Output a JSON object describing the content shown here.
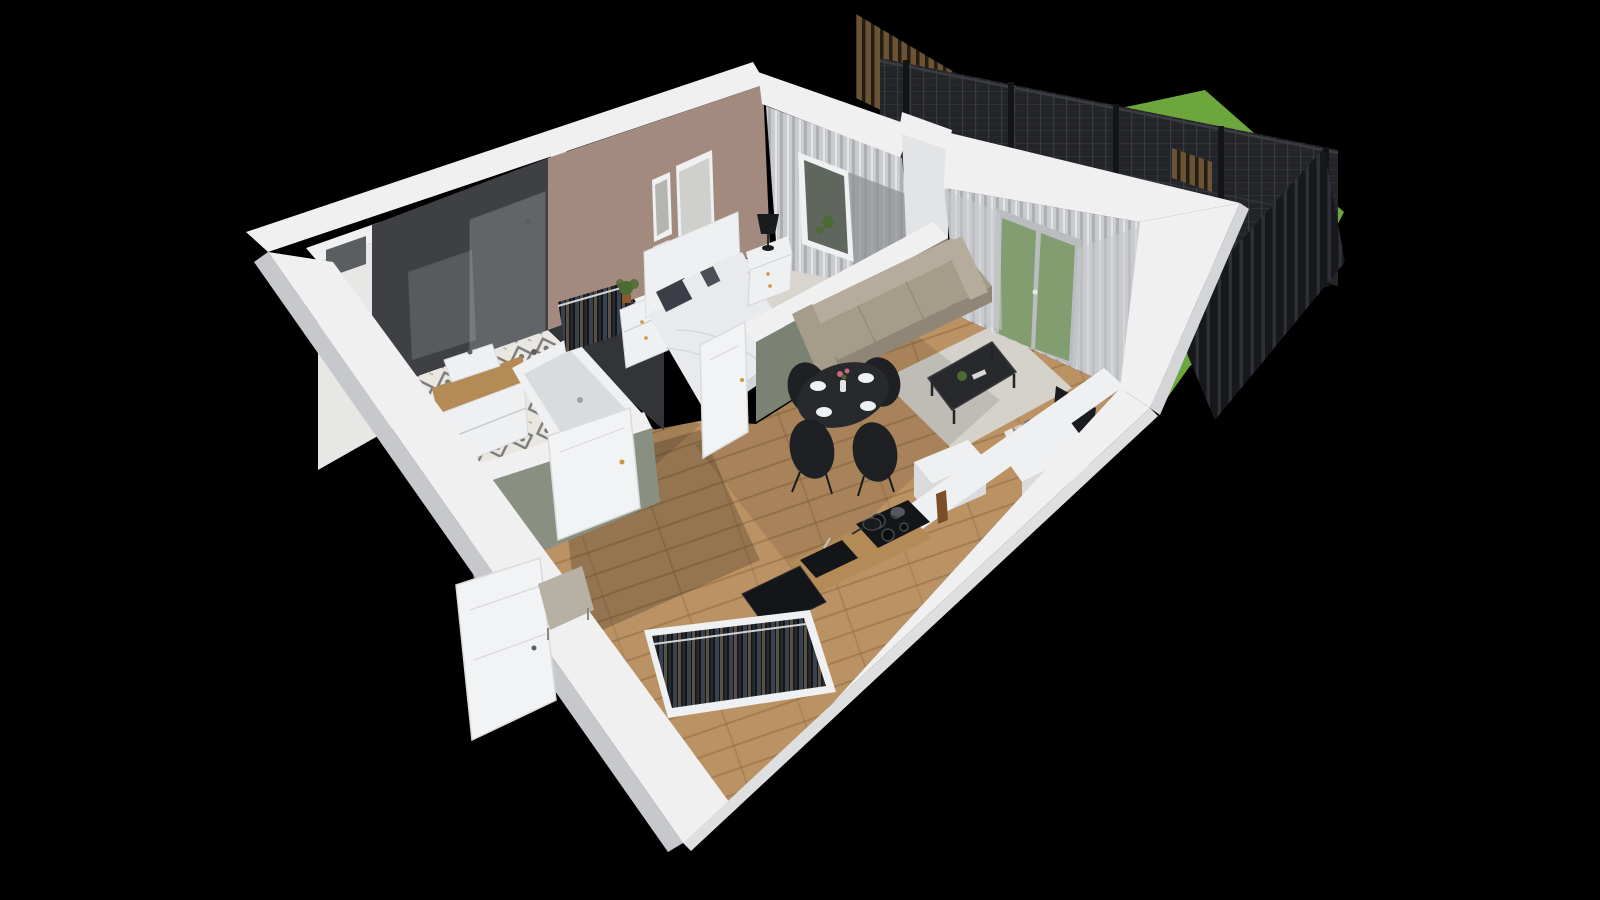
{
  "scene": {
    "type": "3d-floorplan-render",
    "view": "elevated isometric cutaway, rotated roughly 20 degrees",
    "description": "Photorealistic 3D cutaway render of a one-bedroom apartment with a fenced garden terrace on a black background",
    "rooms": [
      "bathroom",
      "bedroom",
      "hallway",
      "living-room",
      "kitchen-dining",
      "wardrobe-nook",
      "garden-terrace"
    ],
    "objects": {
      "bathroom": [
        "bathtub",
        "vanity-with-washbasin",
        "mirror",
        "toilet",
        "walk-in-shower",
        "tiled-duct-shaft"
      ],
      "bedroom": [
        "double-bed",
        "pillows",
        "headboard",
        "nightstand",
        "table-lamp",
        "clothes-rack",
        "dresser",
        "potted-plant",
        "picture-frames",
        "curtained-window"
      ],
      "living-room": [
        "sofa",
        "coffee-table",
        "area-rug",
        "tv",
        "sideboard-with-books",
        "balcony-french-doors",
        "sheer-curtains"
      ],
      "kitchen-dining": [
        "round-dining-table",
        "four-black-chairs",
        "table-setting",
        "wooden-countertop",
        "cooktop-with-pans",
        "sink",
        "tall-black-cabinet",
        "white-island"
      ],
      "hallway": [
        "entrance-door",
        "bathroom-door",
        "bedroom-door",
        "open-wardrobe-with-clothes",
        "bench"
      ],
      "garden-terrace": [
        "lawn",
        "two-sun-loungers",
        "concrete-patio",
        "mesh-fence-panels",
        "fence-posts",
        "wood-slat-screen",
        "wooden-gate"
      ]
    }
  },
  "palette": {
    "bg": "#000000",
    "wallTop": "#f0f0f1",
    "wallFace": "#e3e4e6",
    "wallOuterSW": "#c7c8cb",
    "wallOuterSE": "#dedfe1",
    "wallOuterE": "#d4d5d8",
    "taupe": "#a28b7e",
    "charcoalNW": "#3f4043",
    "charcoalDiv": "#333437",
    "shaftTile": "#e7e7e5",
    "tileBase": "#e9e7e0",
    "tileMotif": "#5f6167",
    "carpet": "#d9d5ce",
    "wood": "#bb9264",
    "woodDark": "#8f6b42",
    "rug": "#d5d2cb",
    "grass": "#6ea63e",
    "grassLight": "#7fb449",
    "grassDark": "#55862e",
    "patio": "#b7bab2",
    "mesh": "#232428",
    "meshLine": "#3a3c42",
    "post": "#131416",
    "slat": "#6b5335",
    "slatGap": "#251d12",
    "board": "#17181b",
    "boardGap": "#2e3035",
    "curtain": "#c9cbce",
    "curtainStripe": "#aaacb1",
    "curtainDark": "#8f9195",
    "glassWindow": "#5e665e",
    "glassDoor": "#7d9a68",
    "doorFrame": "#b9bdbf",
    "oliveFace": "#7c8273",
    "oliveHall": "#899082",
    "sofa": "#a59c8a",
    "sofaLight": "#b5ac9b",
    "sofaShade": "#8f8677",
    "tableBlack": "#28292c",
    "chairBlack": "#1f2023",
    "linen": "#e8eaed",
    "linenShade": "#d2d5da",
    "pillowDark": "#3b3e46",
    "whiteFurn": "#eef0f1",
    "whiteShade": "#d9dbdd",
    "tv": "#1b1c1f",
    "woodCounter": "#b48a56",
    "applianceBlack": "#141518",
    "clothesBase": "#141517",
    "stripeA": "#39414f",
    "stripeB": "#5a5146",
    "stripeC": "#262a31",
    "door": "#f2f3f4",
    "bench": "#b7b1a5",
    "knob": "#c9973f",
    "plant": "#4c6a33",
    "books": "#e8e8e6",
    "mirror": "#5a5e60",
    "lamp": "#1a1b1d",
    "flower": "#c96a77"
  }
}
